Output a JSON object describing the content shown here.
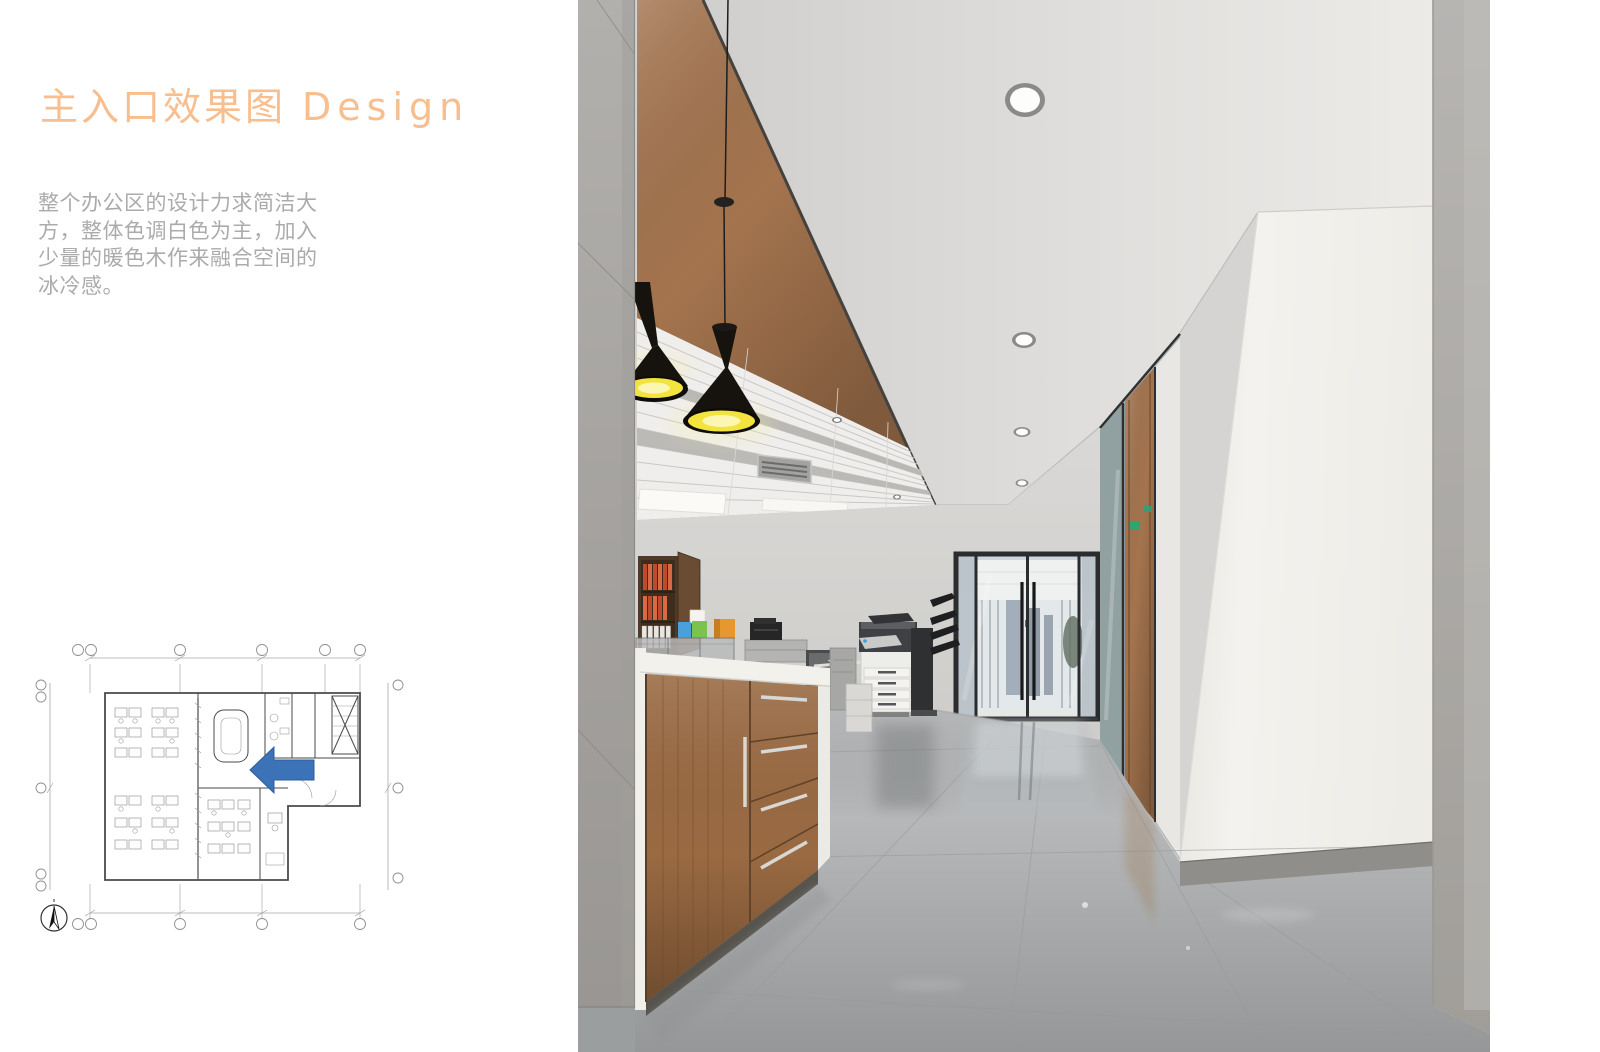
{
  "slide": {
    "title": {
      "zh": "主入口效果图",
      "en": "Design"
    },
    "description_lines": [
      "整个办公区的设计力求简洁大",
      "方，整体色调白色为主，加入",
      "少量的暖色木作来融合空间的",
      "冰冷感。"
    ]
  },
  "colors": {
    "page_bg": "#ffffff",
    "accent": "#f8be8e",
    "body_text": "#ababab",
    "copper": "#a4744e",
    "lamp_black": "#16130f",
    "lamp_yellow": "#f2e33e",
    "wood": "#9a6a42",
    "floor": "#b6b8b9",
    "wall": "#d5d4d2",
    "white_column": "#f2f0ec",
    "frame_dark": "#2b2c2e",
    "arrow_blue": "#3c72b8",
    "exit_green": "#2fa276",
    "plan_line": "#a6a6a6",
    "plan_wall": "#4a4a4a",
    "sky_glass": "#c6d1d9"
  },
  "icons": {
    "entrance_arrow": "left-arrow",
    "north_arrow": "compass-needle"
  }
}
